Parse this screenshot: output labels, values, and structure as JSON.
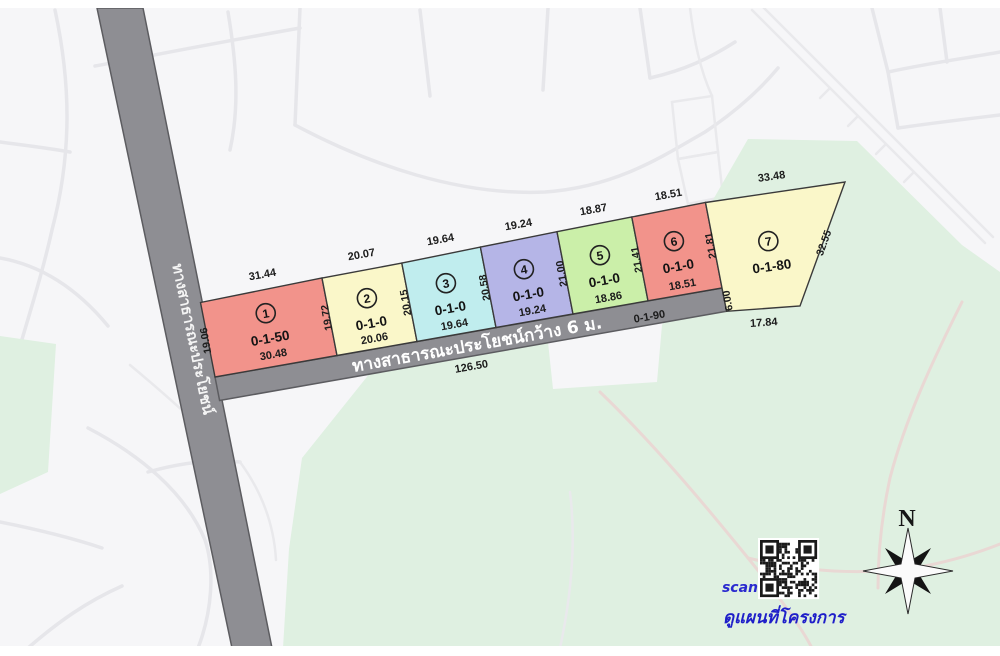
{
  "map": {
    "colors": {
      "land": "#f6f6f8",
      "green_area": "#dff0e1",
      "road_gray": "#8e8e93",
      "road_border": "#5c5c60",
      "plot_stroke": "#3a3a3a",
      "blue_text": "#2222cc"
    },
    "roads": {
      "vertical": {
        "label": "ทางสาธารณะประโยชน์"
      },
      "horizontal": {
        "label": "ทางสาธารณะประโยชน์กว้าง 6 ม.",
        "length": "126.50",
        "area": "0-1-90",
        "width_label": "6.00"
      }
    },
    "plots": [
      {
        "number": "1",
        "area": "0-1-50",
        "color": "#f2938b",
        "dims": {
          "top": "31.44",
          "left": "19.06",
          "bottom": "30.48"
        }
      },
      {
        "number": "2",
        "area": "0-1-0",
        "color": "#faf7c9",
        "dims": {
          "top": "20.07",
          "left": "19.72",
          "bottom": "20.06"
        }
      },
      {
        "number": "3",
        "area": "0-1-0",
        "color": "#c0edee",
        "dims": {
          "top": "19.64",
          "left": "20.15",
          "bottom": "19.64"
        }
      },
      {
        "number": "4",
        "area": "0-1-0",
        "color": "#b5b5e7",
        "dims": {
          "top": "19.24",
          "left": "20.58",
          "bottom": "19.24"
        }
      },
      {
        "number": "5",
        "area": "0-1-0",
        "color": "#cbefa9",
        "dims": {
          "top": "18.87",
          "left": "21.00",
          "bottom": "18.86"
        }
      },
      {
        "number": "6",
        "area": "0-1-0",
        "color": "#f2938b",
        "dims": {
          "top": "18.51",
          "left": "21.41",
          "bottom": "18.51"
        }
      },
      {
        "number": "7",
        "area": "0-1-80",
        "color": "#faf7c9",
        "dims": {
          "top": "33.48",
          "left": "21.81",
          "right": "32.55",
          "bottom": "17.84"
        }
      }
    ],
    "compass": {
      "label": "N"
    },
    "qr": {
      "scan": "scan",
      "caption": "ดูแผนที่โครงการ"
    }
  }
}
